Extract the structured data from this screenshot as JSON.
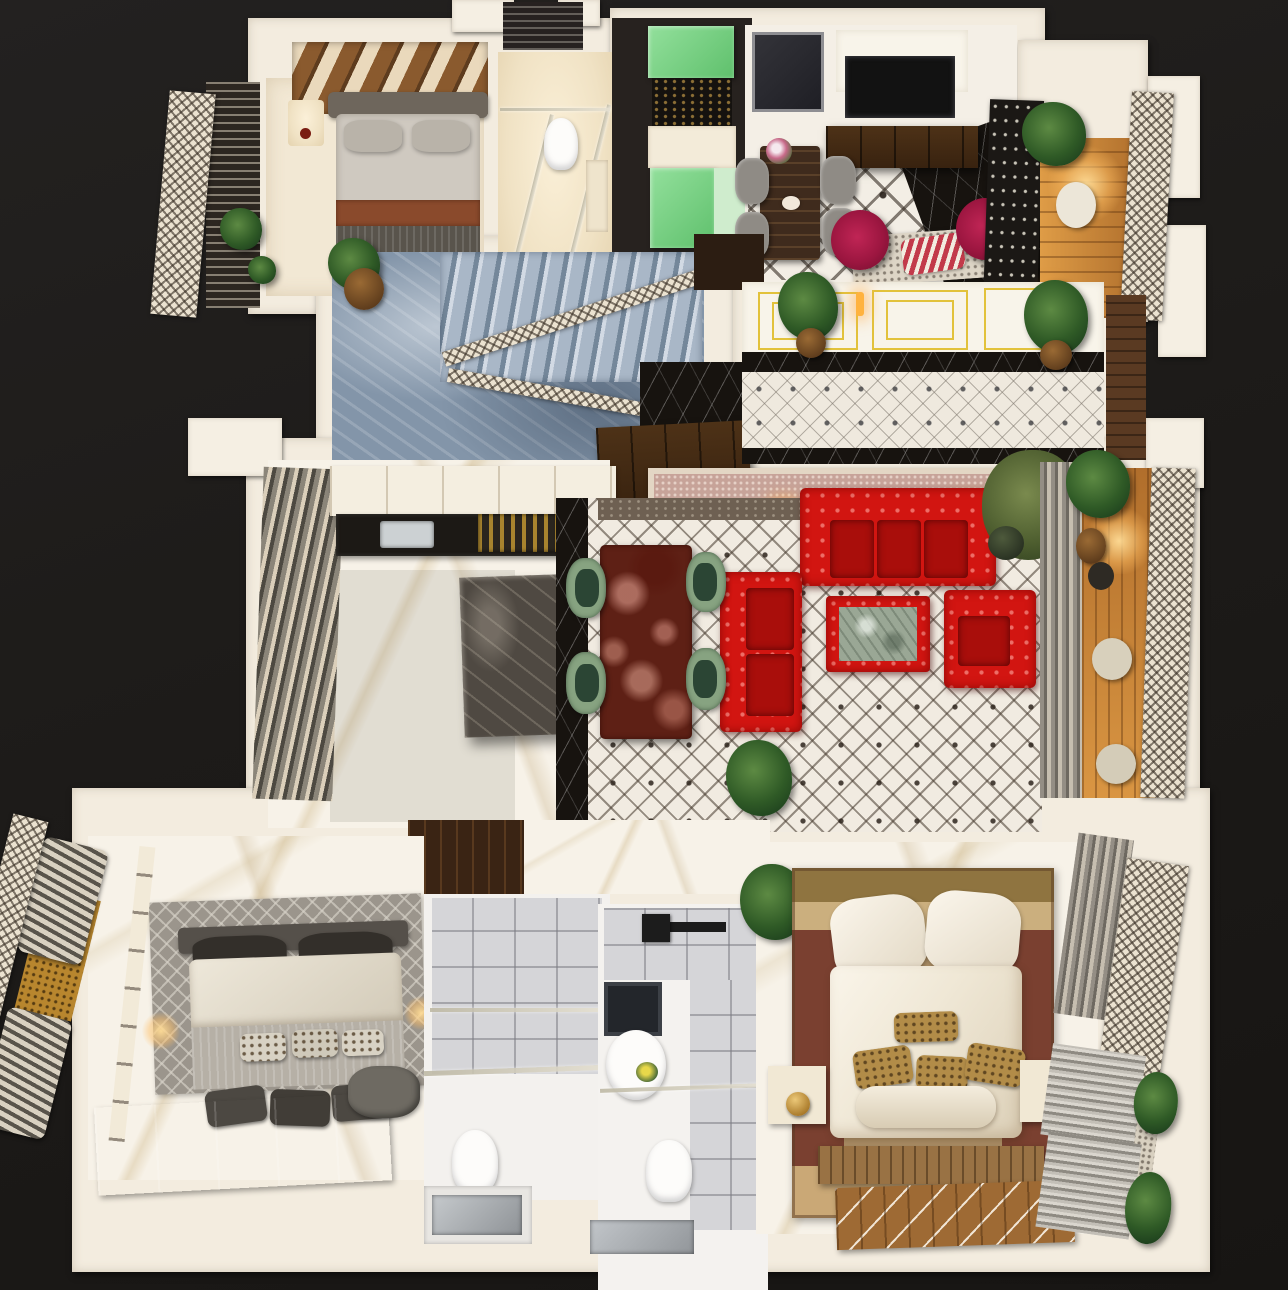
{
  "scene": {
    "title": "3D rendered apartment floor plan - top view",
    "background_color": "#1d1b19",
    "style": "isometric architectural render, cutaway walls"
  },
  "palette": {
    "wall_white": "#f3ecdf",
    "wall_cream": "#efe4d0",
    "sofa_red": "#d21511",
    "chair_maroon": "#9c1640",
    "chair_green": "#87a381",
    "table_marble_red": "#5e2015",
    "coffee_table_marble_green": "#9aa795",
    "stairs_marble_blue": "#8395a9",
    "tile_white": "#f1ebe1",
    "tile_accent_dark": "#3a302a",
    "marble_black": "#17130f",
    "balcony_wood": "#cd8a3c",
    "pantry_green": "#7ed287",
    "gold_trim": "#e2c23c",
    "kilim_carpet": "#b2946a",
    "bed_mat_green": "#5b8756",
    "bath_tile_gray": "#d5d5d8",
    "corridor_carpet_pink": "#c7a399"
  },
  "rooms": {
    "bedroom_top_left": {
      "label": "Bedroom with wood accent wall and gray bed"
    },
    "bathroom_top": {
      "label": "Ensuite bathroom with glass shower"
    },
    "pantry": {
      "label": "Green pantry / kitchenette"
    },
    "dining_family": {
      "label": "Family lounge with dining table, TV unit and maroon chairs"
    },
    "balcony_top_right": {
      "label": "Wooden balcony with lattice railing"
    },
    "stair_hall": {
      "label": "Staircase hall with blue marble floor"
    },
    "entrance_hall": {
      "label": "Entrance hallway with gold wainscot panels"
    },
    "corridor": {
      "label": "Corridor with pink carpet and sconces"
    },
    "kitchen": {
      "label": "Kitchen with island and marble floor"
    },
    "living_room": {
      "label": "Living room with red chesterfield sofas"
    },
    "balcony_mid_right": {
      "label": "Side balcony with plants and stools"
    },
    "bedroom_bottom_left": {
      "label": "Bedroom with gray bed and green mat"
    },
    "bathroom_a": {
      "label": "Bathroom with shower and laundry tray"
    },
    "bathroom_b": {
      "label": "Bathroom with vanity mirror and shower"
    },
    "master_bedroom": {
      "label": "Master bedroom with kilim rug and white bed"
    },
    "balcony_master": {
      "label": "Master balcony with louvers and shrubs"
    }
  },
  "furniture": {
    "red_sofa_3seat": "Three-seat red tufted sofa",
    "red_loveseat": "Two-seat red tufted sofa",
    "red_armchair": "Red tufted armchair",
    "coffee_table": "Red-framed coffee table with green marble top",
    "dining_table_marble": "Red marble dining table with four green chairs",
    "kitchen_island": "Dark stone kitchen island",
    "stairs": "Marble staircase with ornate white railing",
    "master_bed": "King bed with white duvet and gold pillows",
    "guest_bed": "Bed with gray duvet and leather cushions"
  }
}
